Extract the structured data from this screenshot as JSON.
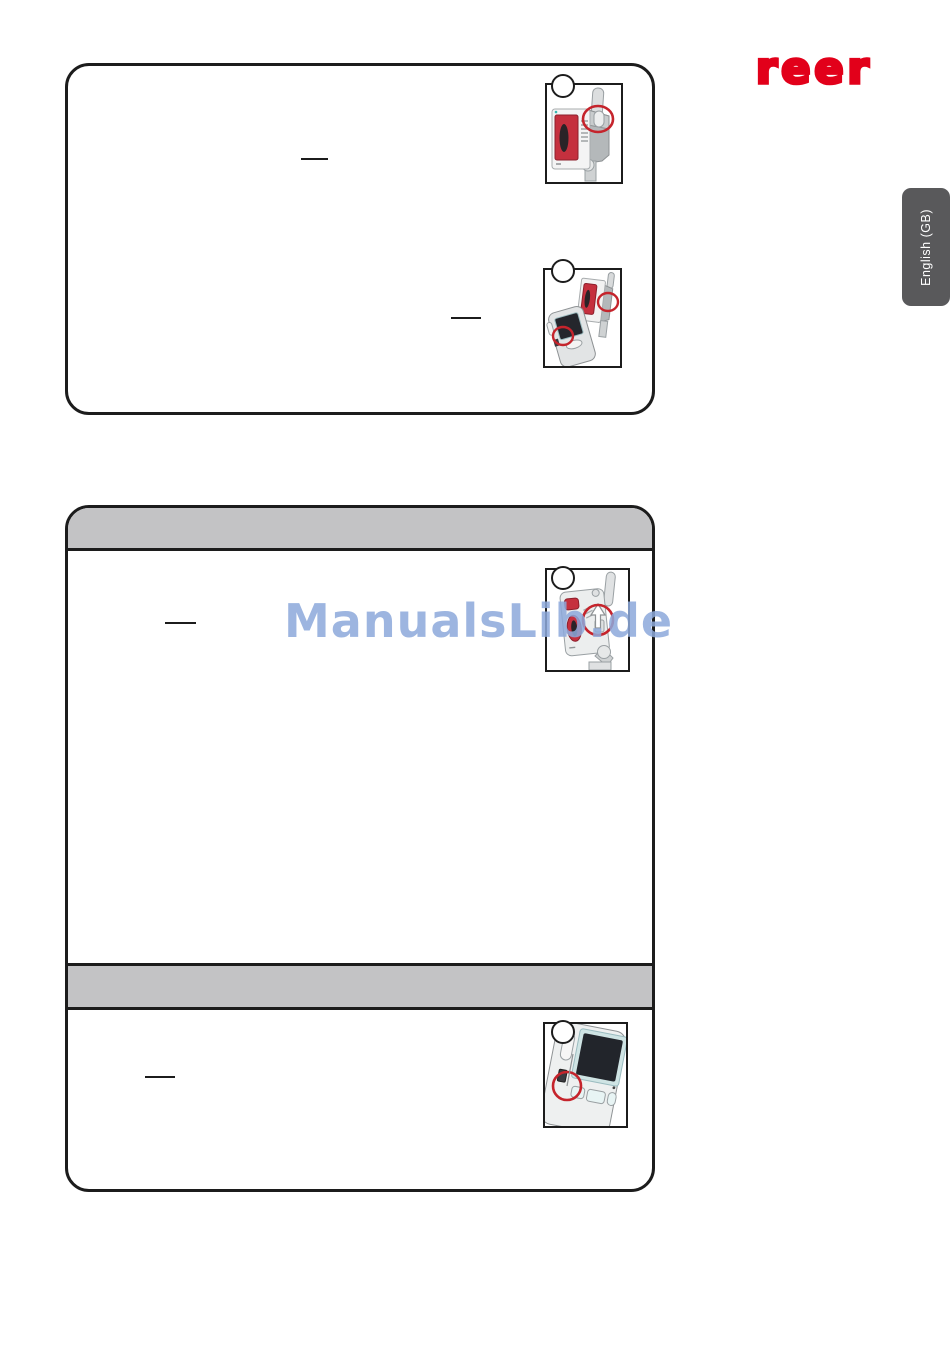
{
  "page": {
    "type": "instruction-manual-scan",
    "background": "#ffffff"
  },
  "brand": {
    "logo_text": "reer",
    "logo_color": "#e2001a"
  },
  "language_tab": {
    "label": "English (GB)",
    "background": "#59595b",
    "text_color": "#ffffff"
  },
  "watermark": {
    "text": "ManualsLib.de",
    "color": "#8da9db"
  },
  "colors": {
    "box_border": "#1c1c1c",
    "section_bar_fill": "#c3c3c5",
    "annotation_red": "#c5242c",
    "device_panel_red": "#c5303e",
    "device_body_light": "#f0f1f1",
    "device_body_gray": "#b4b8ba",
    "screen_dark": "#24262c"
  },
  "sections": {
    "box1": {
      "header_bar": false,
      "figure_count": 2,
      "redacted_underline_count": 2
    },
    "box2": {
      "header_bar": true,
      "mid_bar": true,
      "figure_count": 2,
      "redacted_underline_count": 2
    }
  },
  "figures": [
    {
      "name": "baby-unit-top-button-figure",
      "step_circle_label": ""
    },
    {
      "name": "baby-and-parent-unit-link-buttons-figure",
      "step_circle_label": ""
    },
    {
      "name": "baby-unit-up-switch-figure",
      "step_circle_label": ""
    },
    {
      "name": "parent-unit-side-switch-figure",
      "step_circle_label": ""
    }
  ]
}
